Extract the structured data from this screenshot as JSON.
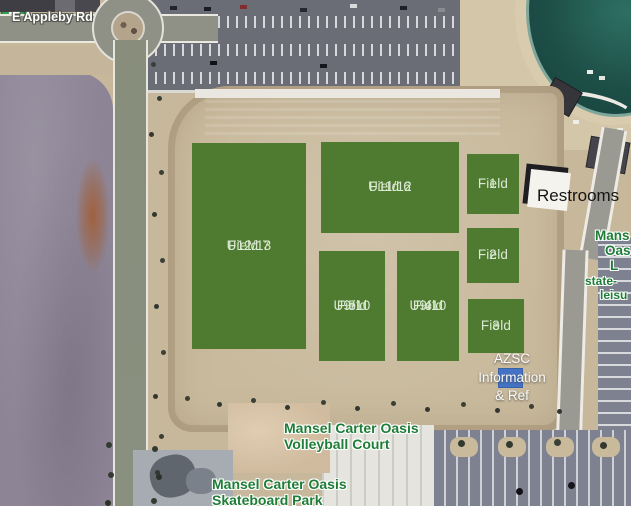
{
  "map": {
    "road_label": "E Appleby Rd",
    "restrooms_label": "Restrooms",
    "fields": {
      "field7": {
        "line1": "U12/13",
        "line2": "Field 7"
      },
      "field6": {
        "line1": "U11/12",
        "line2": "Field 6"
      },
      "field5": {
        "line1": "U9/10",
        "line2": "Field",
        "line3": "5"
      },
      "field4": {
        "line1": "U9/10",
        "line2": "Field",
        "line3": "4"
      },
      "field1": {
        "line1": "Field",
        "line2": "1"
      },
      "field2": {
        "line1": "Field",
        "line2": "2"
      },
      "field3": {
        "line1": "Field",
        "line2": "3"
      }
    },
    "azsc_label": {
      "line1": "AZSC",
      "line2": "Information",
      "line3": "& Ref"
    },
    "volleyball_label": {
      "line1": "Mansel Carter Oasis",
      "line2": "Volleyball Court"
    },
    "skatepark_label": {
      "line1": "Mansel Carter Oasis",
      "line2": "Skateboard Park"
    },
    "right_edge_label": {
      "line1": "Mans",
      "line2": "Oas",
      "line3": "L",
      "line4": "state-",
      "line5": "leisu"
    },
    "colors": {
      "field_green": "#4F7B31",
      "field_text": "#DBE9D3",
      "poi_label_green": "#1E7D36",
      "azsc_marker_blue": "#4472C4",
      "pin_green": "#34A156"
    }
  }
}
